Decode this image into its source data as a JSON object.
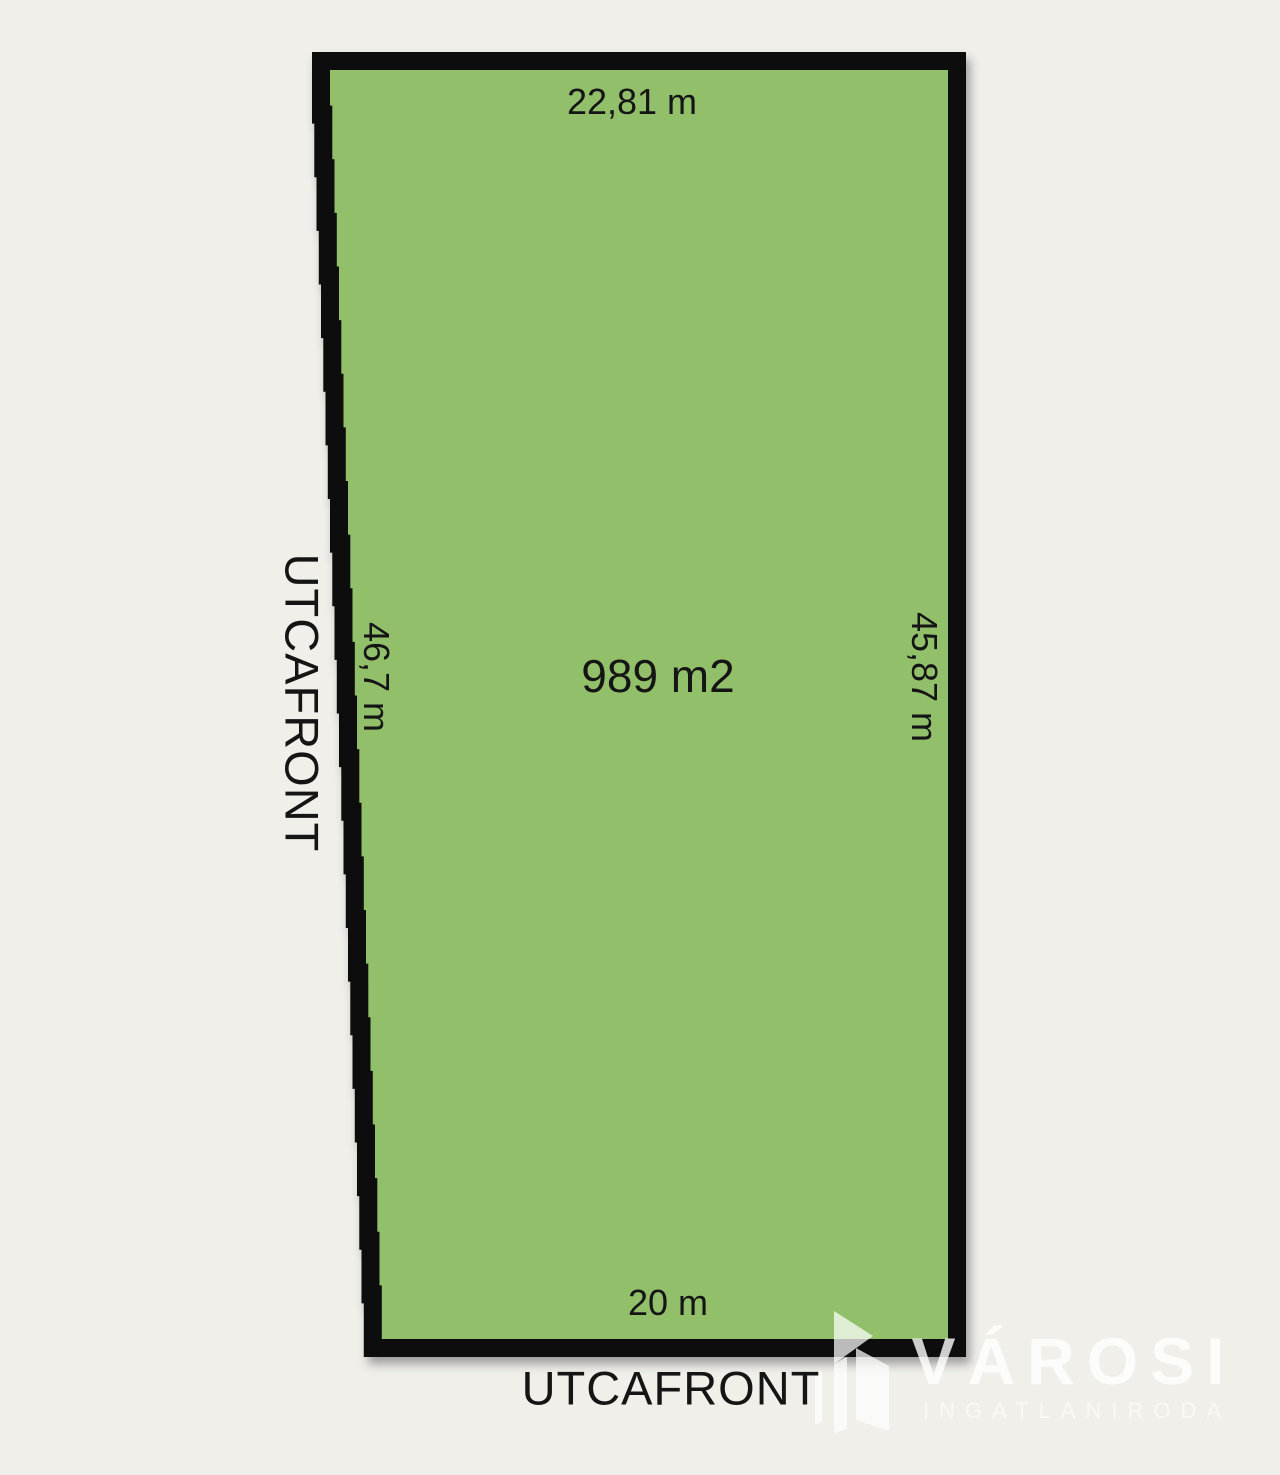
{
  "canvas": {
    "background_color": "#f0efea"
  },
  "parcel": {
    "fill_color": "#92c06a",
    "border_color": "#0d0d0d",
    "area_label": "989 m2",
    "dim_top": "22,81 m",
    "dim_left": "46,7 m",
    "dim_right": "45,87 m",
    "dim_bottom": "20 m"
  },
  "street": {
    "left_label": "UTCAFRONT",
    "bottom_label": "UTCAFRONT"
  },
  "watermark": {
    "brand": "VÁROSI",
    "subtitle": "INGATLANIRODA",
    "color": "#ffffff"
  }
}
